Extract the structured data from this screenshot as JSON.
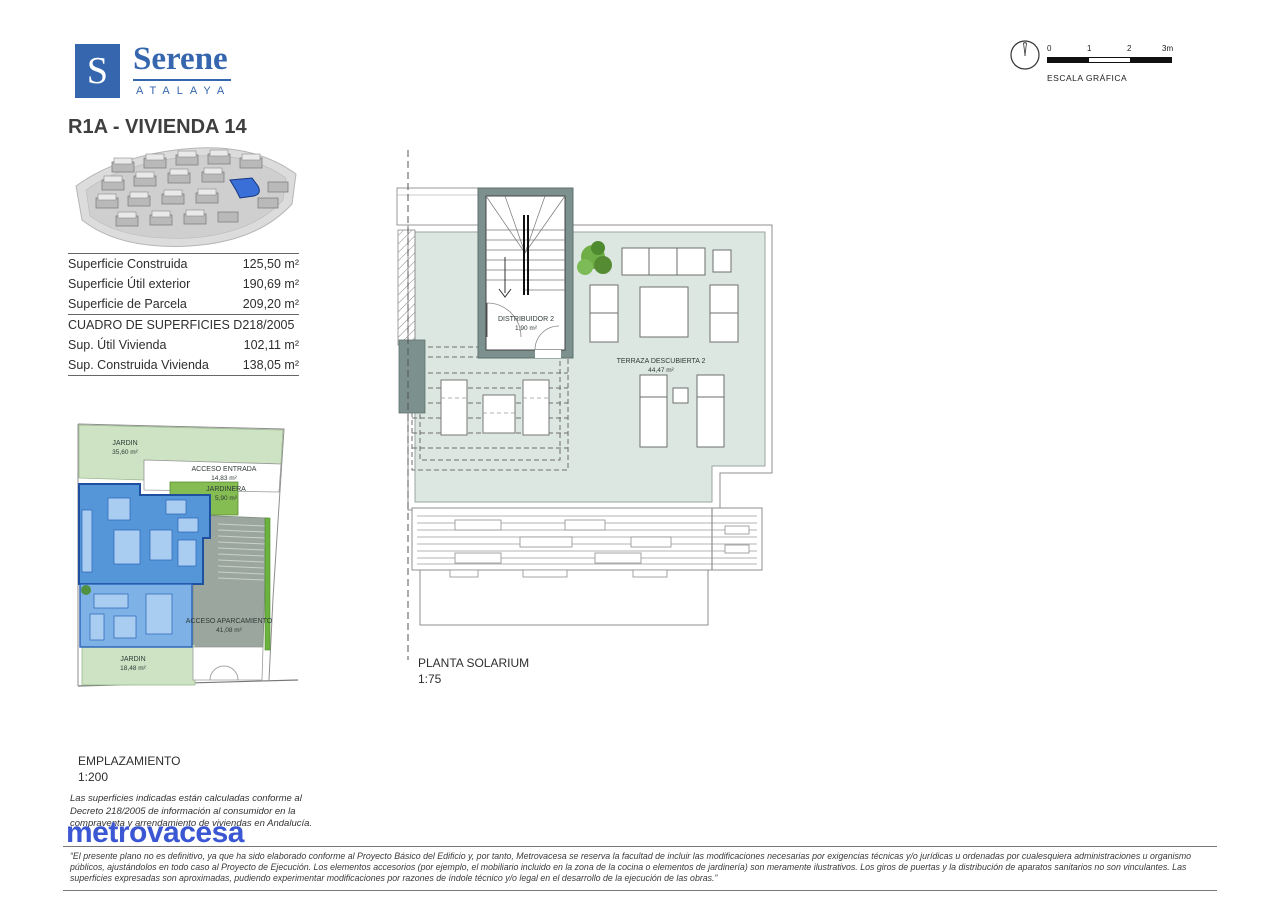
{
  "brand": {
    "logo_letter": "S",
    "logo_name": "Serene",
    "logo_sub": "ATALAYA",
    "accent": "#3566ae"
  },
  "title": "R1A - VIVIENDA 14",
  "scale_bar": {
    "ticks": [
      "0",
      "1",
      "2",
      "3m"
    ],
    "label": "ESCALA GRÁFICA"
  },
  "surfaces": {
    "rows": [
      {
        "label": "Superficie Construida",
        "value": "125,50 m²"
      },
      {
        "label": "Superficie Útil exterior",
        "value": "190,69 m²"
      },
      {
        "label": "Superficie de Parcela",
        "value": "209,20 m²"
      }
    ],
    "section_header": "CUADRO DE SUPERFICIES D218/2005",
    "rows2": [
      {
        "label": "Sup. Útil Vivienda",
        "value": "102,11 m²"
      },
      {
        "label": "Sup. Construida Vivienda",
        "value": "138,05 m²"
      }
    ]
  },
  "site_plan": {
    "caption": "EMPLAZAMIENTO",
    "scale": "1:200",
    "labels": {
      "jardin_top": {
        "name": "JARDIN",
        "area": "35,60 m²"
      },
      "acceso_entrada": {
        "name": "ACCESO ENTRADA",
        "area": "14,83 m²"
      },
      "jardinera": {
        "name": "JARDINERA",
        "area": "5,90 m²"
      },
      "acceso_aparcamiento": {
        "name": "ACCESO APARCAMIENTO",
        "area": "41,08 m²"
      },
      "jardin_bottom": {
        "name": "JARDIN",
        "area": "18,48 m²"
      }
    }
  },
  "floor_plan": {
    "caption": "PLANTA SOLARIUM",
    "scale": "1:75",
    "labels": {
      "distribuidor": {
        "name": "DISTRIBUIDOR 2",
        "area": "1,90 m²"
      },
      "terraza": {
        "name": "TERRAZA DESCUBIERTA 2",
        "area": "44,47 m²"
      }
    }
  },
  "legal_note": "Las superficies indicadas están calculadas conforme al Decreto 218/2005 de información al consumidor en la compraventa y arrendamiento de viviendas en Andalucía.",
  "developer_logo": "metrovacesa",
  "disclaimer": "“El presente plano no es definitivo, ya que ha sido elaborado conforme al Proyecto Básico del Edificio y, por tanto, Metrovacesa se reserva la facultad de incluir las modificaciones necesarias por exigencias técnicas y/o jurídicas u ordenadas por cualesquiera administraciones u organismo públicos, ajustándolos en todo caso al Proyecto de Ejecución. Los elementos accesorios (por ejemplo, el mobiliario incluido en la zona de la cocina o elementos de jardinería) son meramente ilustrativos. Los giros de puertas y la distribución de aparatos sanitarios no son vinculantes. Las superficies expresadas son aproximadas, pudiendo experimentar modificaciones por razones de índole técnico y/o legal en el desarrollo de la ejecución de las obras.”"
}
